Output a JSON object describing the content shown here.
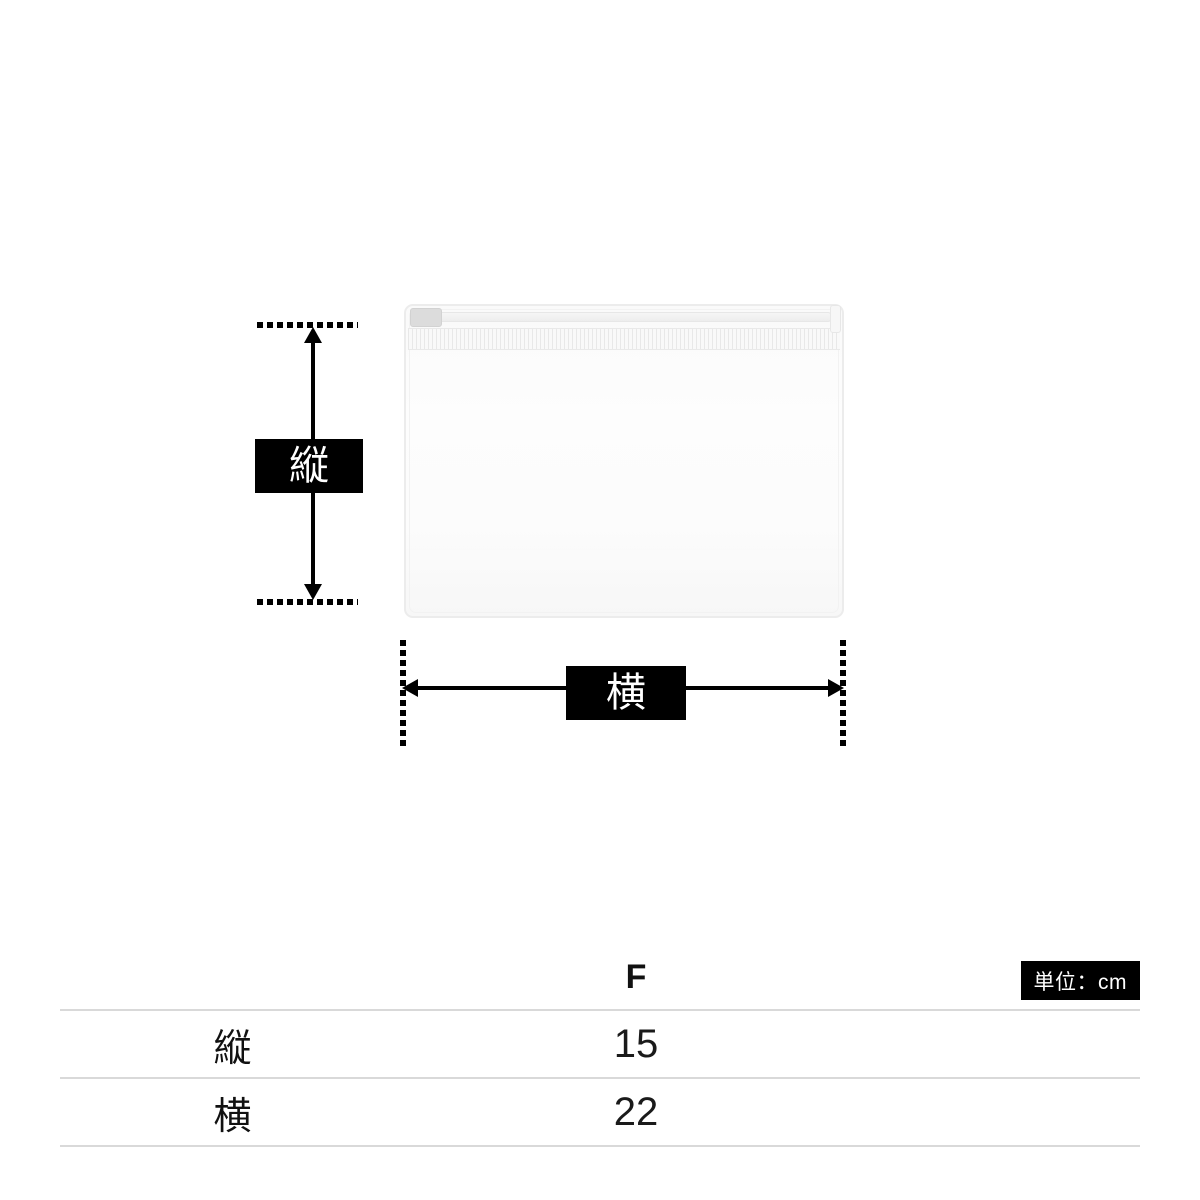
{
  "diagram": {
    "vertical_label": "縦",
    "horizontal_label": "横"
  },
  "size_table": {
    "unit_label": "単位：cm",
    "column_header": "F",
    "rows": [
      {
        "label": "縦",
        "value": "15"
      },
      {
        "label": "横",
        "value": "22"
      }
    ]
  },
  "colors": {
    "marker_black": "#000000",
    "table_line": "#d9d9d9",
    "pouch_edge": "#ececec",
    "badge_background": "#000000",
    "badge_text": "#ffffff"
  }
}
